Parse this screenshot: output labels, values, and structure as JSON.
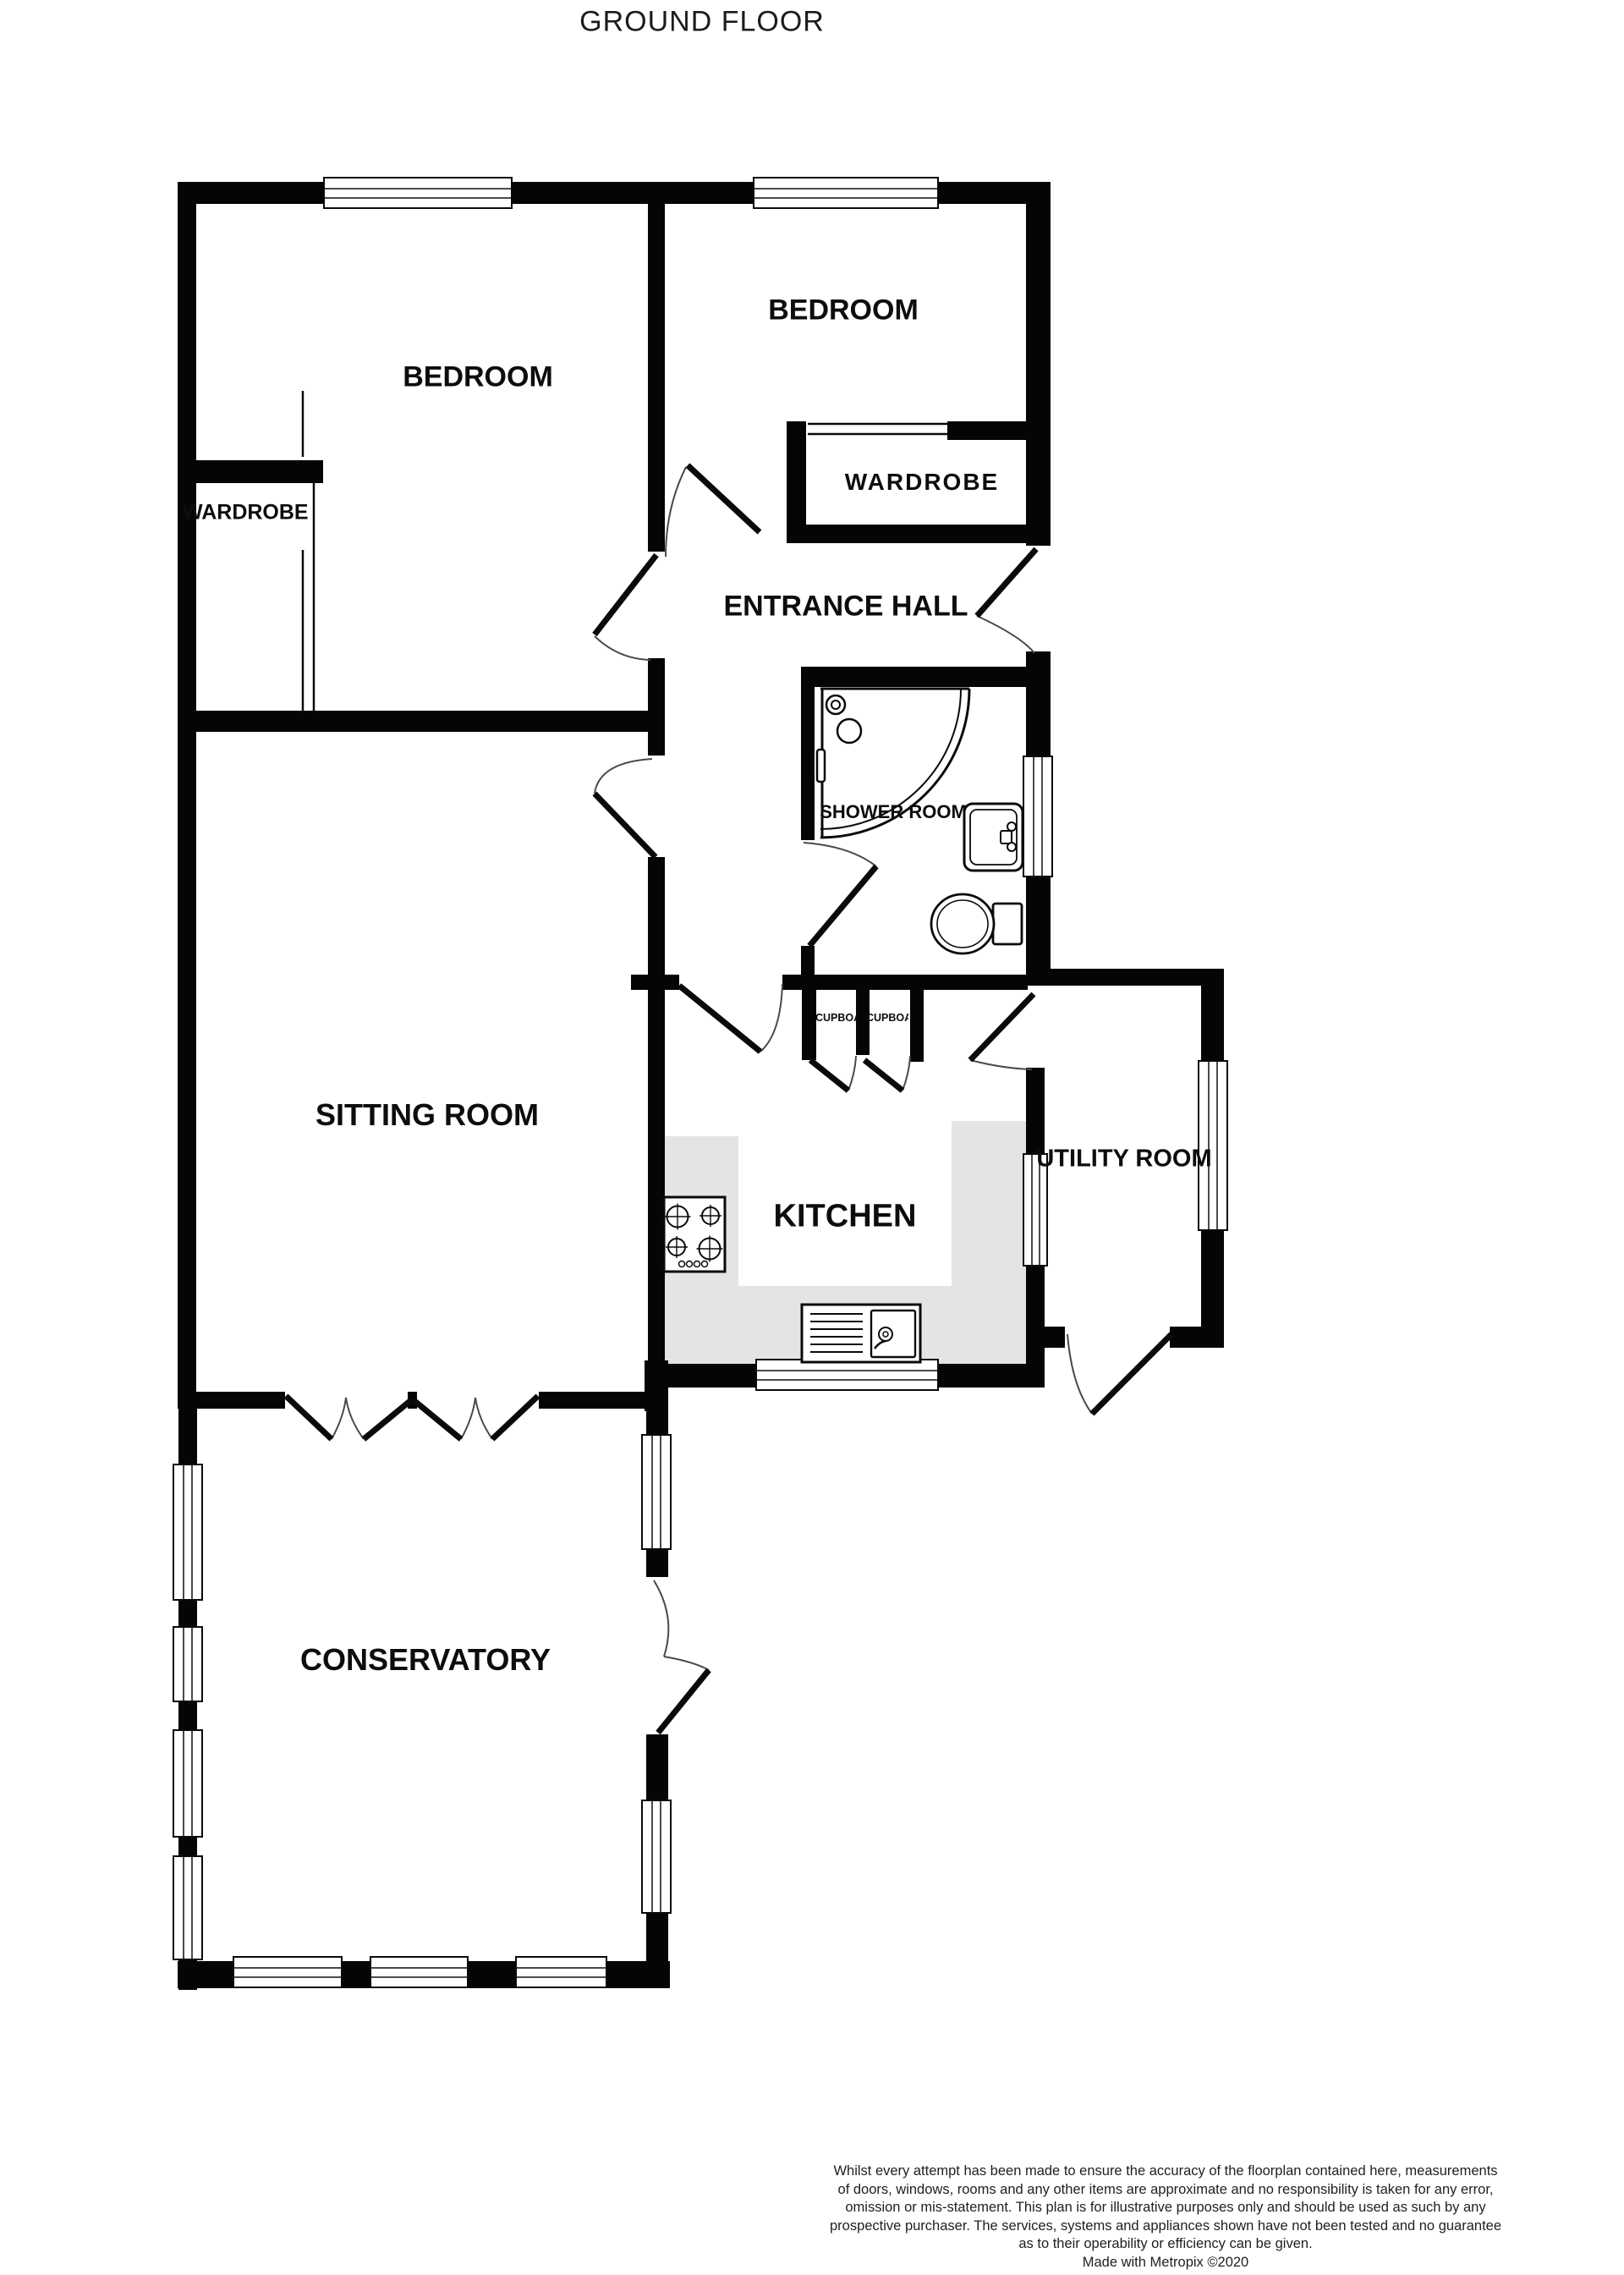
{
  "title": "GROUND FLOOR",
  "colors": {
    "wall": "#050505",
    "counter_fill": "#e4e4e4",
    "door_leaf": "#0a0a0a",
    "swing_arc": "#4a4a4a",
    "label_text": "#0d0d0d"
  },
  "rooms": {
    "bedroom1": {
      "label": "BEDROOM"
    },
    "bedroom2": {
      "label": "BEDROOM"
    },
    "wardrobe1": {
      "label": "WARDROBE"
    },
    "wardrobe2": {
      "label": "WARDROBE"
    },
    "entrance_hall": {
      "label": "ENTRANCE HALL"
    },
    "shower_room": {
      "label": "SHOWER ROOM"
    },
    "sitting_room": {
      "label": "SITTING ROOM"
    },
    "kitchen": {
      "label": "KITCHEN"
    },
    "utility_room": {
      "label": "UTILITY ROOM"
    },
    "conservatory": {
      "label": "CONSERVATORY"
    },
    "cupboard1": {
      "label": "CUPBOARD"
    },
    "cupboard2": {
      "label": "CUPBOARD"
    }
  },
  "fixtures": [
    "corner-shower",
    "wash-basin",
    "toilet",
    "hob",
    "sink-drainer"
  ],
  "footer": {
    "disclaimer_lines": [
      "Whilst every attempt has been made to ensure the accuracy of the floorplan contained here, measurements",
      "of doors, windows, rooms and any other items are approximate and no responsibility is taken for any error,",
      "omission or mis-statement. This plan is for illustrative purposes only and should be used as such by any",
      "prospective purchaser. The services, systems and appliances shown have not been tested and no guarantee",
      "as to their operability or efficiency can be given."
    ],
    "credit": "Made with Metropix ©2020"
  }
}
